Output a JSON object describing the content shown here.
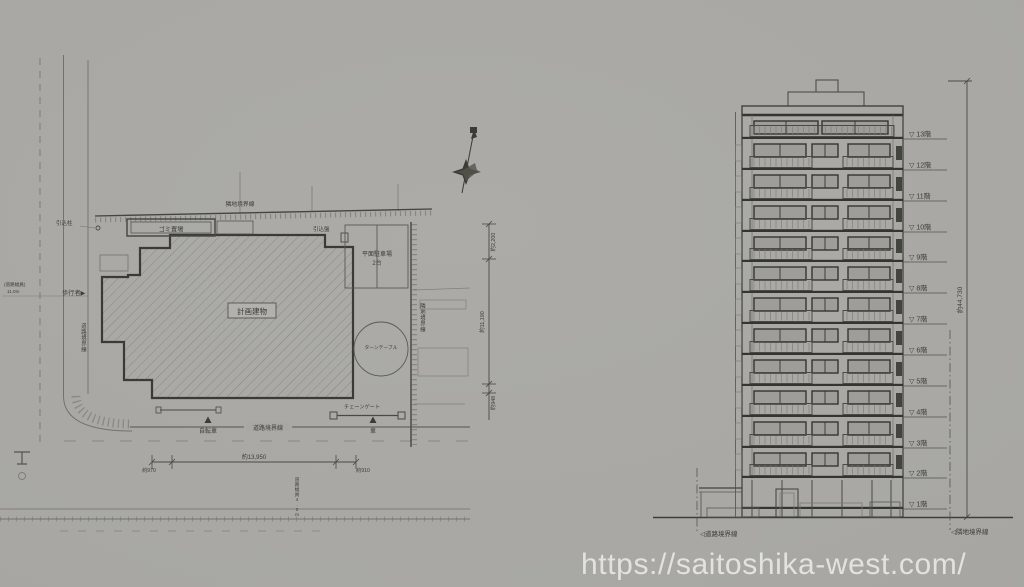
{
  "colors": {
    "paper": "#a8a7a3",
    "ink": "#3c3c36",
    "ink_light": "#72726c",
    "watermark": "#e3e2df"
  },
  "watermark": {
    "text": "https://saitoshika-west.com/"
  },
  "site_plan": {
    "labels": {
      "lead_in_pole": "引込柱",
      "boundary_top": "隣地境界線",
      "garbage": "ゴミ置場",
      "lead_in_panel": "引込盤",
      "planned_building": "計画建物",
      "parking_line1": "平面駐車場",
      "parking_line2": "2台",
      "turntable": "ターンテーブル",
      "chain_gate": "チェーンゲート",
      "boundary_right_vertical": "隣地境界線",
      "boundary_road_left_vertical": "道路境界線",
      "boundary_road_bottom": "道路境界線",
      "pedestrian": "歩行者▶",
      "bicycle": "自転車",
      "car": "車",
      "road_width_left_l1": "(道路幅員)",
      "road_width_left_l2": "11.0m",
      "road_width_bottom": "道路幅員4.0m"
    },
    "dimensions": {
      "right_top": "約2,200",
      "right_mid": "約11,190",
      "right_bottom": "約948",
      "bottom_left": "約970",
      "bottom_main": "約13,950",
      "bottom_right": "約910"
    }
  },
  "elevation": {
    "floor_marker": "▽",
    "floors": [
      "13階",
      "12階",
      "11階",
      "10階",
      "9階",
      "8階",
      "7階",
      "6階",
      "5階",
      "4階",
      "3階",
      "2階",
      "1階"
    ],
    "total_height": "約44,730",
    "boundary_left": "◁道路境界線",
    "boundary_right": "◁隣地境界線"
  }
}
